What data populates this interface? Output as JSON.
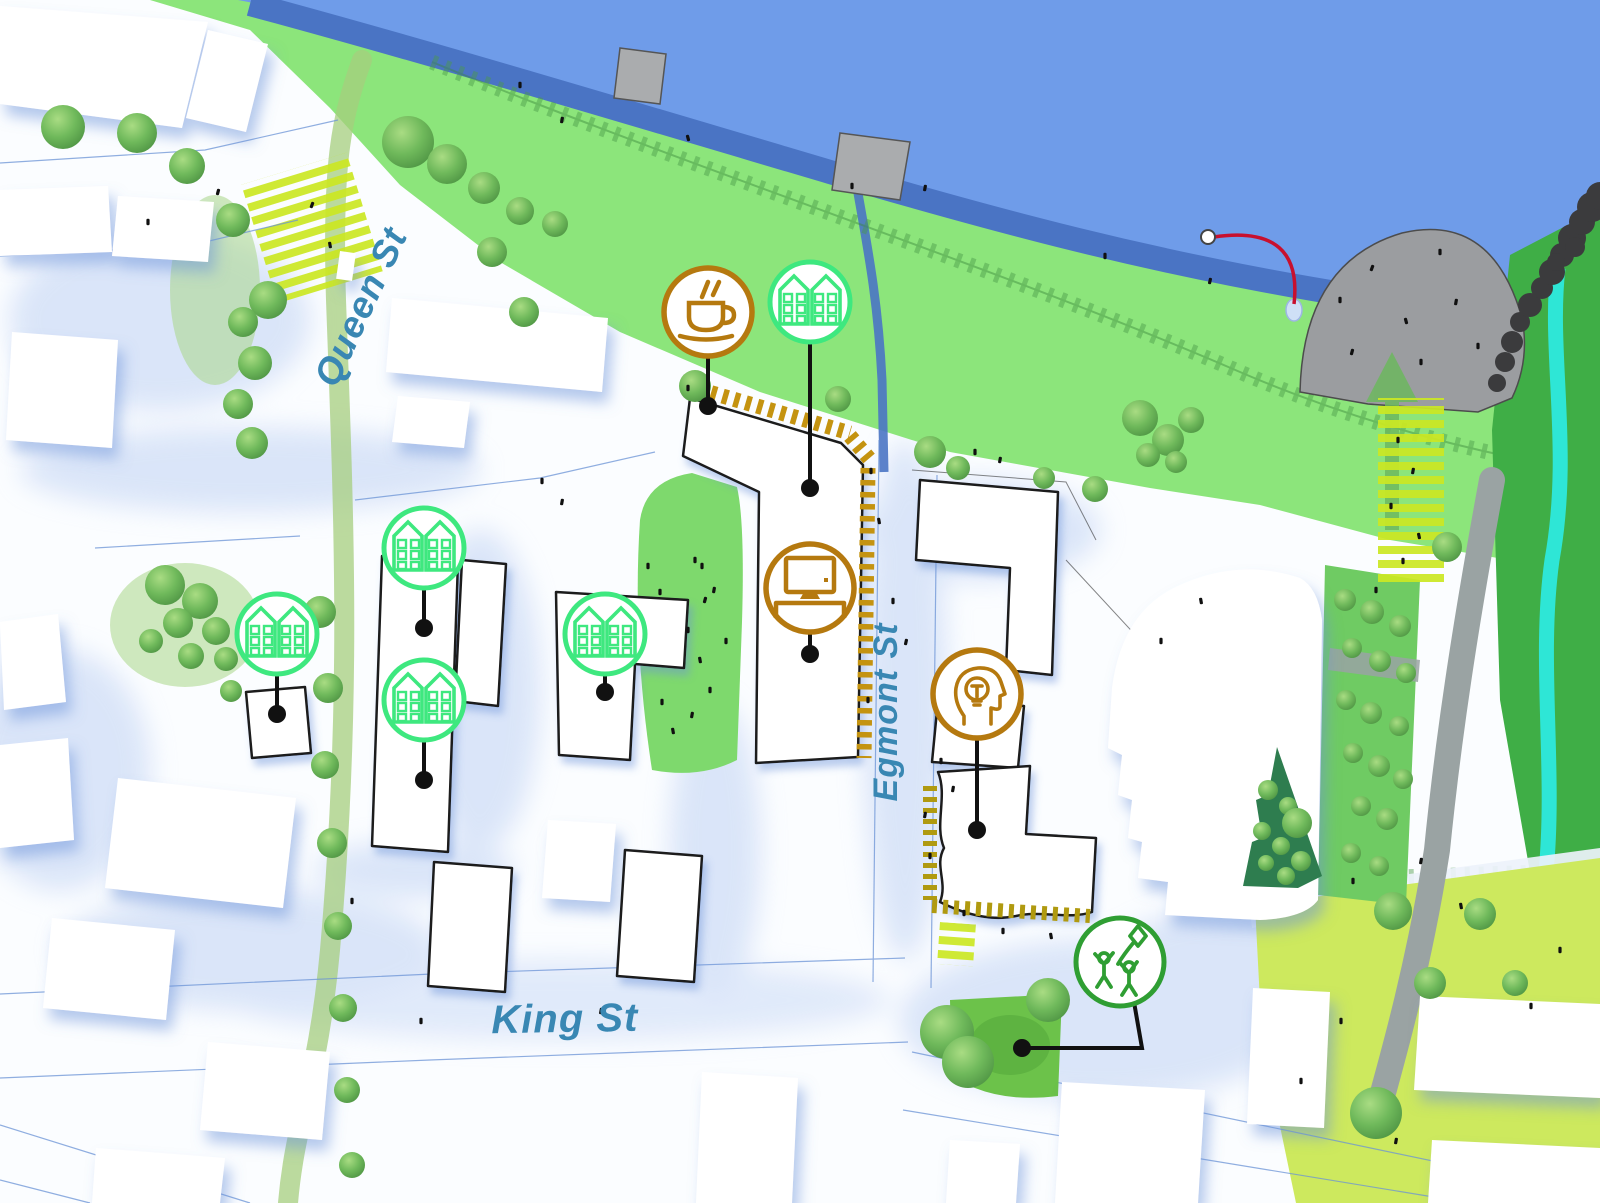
{
  "map": {
    "title": "waterfront-masterplan-map",
    "streets": {
      "queen": "Queen St",
      "king": "King St",
      "egmont": "Egmont St"
    },
    "markers": [
      {
        "id": "cafe",
        "icon": "coffee-icon",
        "category": "cafe",
        "accent": "#b5790f"
      },
      {
        "id": "housing-waterfront",
        "icon": "housing-icon",
        "category": "housing",
        "accent": "#3ee87f"
      },
      {
        "id": "housing-west-upper",
        "icon": "housing-icon",
        "category": "housing",
        "accent": "#3ee87f"
      },
      {
        "id": "housing-west-lower",
        "icon": "housing-icon",
        "category": "housing",
        "accent": "#3ee87f"
      },
      {
        "id": "housing-central",
        "icon": "housing-icon",
        "category": "housing",
        "accent": "#3ee87f"
      },
      {
        "id": "housing-far-west",
        "icon": "housing-icon",
        "category": "housing",
        "accent": "#3ee87f"
      },
      {
        "id": "workspace",
        "icon": "computer-desk-icon",
        "category": "workspace",
        "accent": "#b5790f"
      },
      {
        "id": "innovation",
        "icon": "idea-head-icon",
        "category": "innovation",
        "accent": "#b5790f"
      },
      {
        "id": "play-area",
        "icon": "kids-playing-icon",
        "category": "play",
        "accent": "#2f9e33"
      }
    ],
    "colors": {
      "water": "#6f9ce9",
      "embankment_blue": "#4a74c4",
      "park_green": "#8ce57b",
      "dark_green": "#3fae46",
      "chartreuse": "#cde95e",
      "crosswalk_yellow": "#cbe823",
      "tree_green": "#69b457",
      "building_outline": "#1a1a1a",
      "frontage_hatch_gold": "#c49310",
      "frontage_hatch_olive": "#b09a10",
      "street_label_teal": "#3987b3",
      "pier_gray": "#9b9da0",
      "path_gray": "#9aa3a3",
      "stream_cyan": "#2ee6d6",
      "flight_path_red": "#c8102e"
    }
  }
}
